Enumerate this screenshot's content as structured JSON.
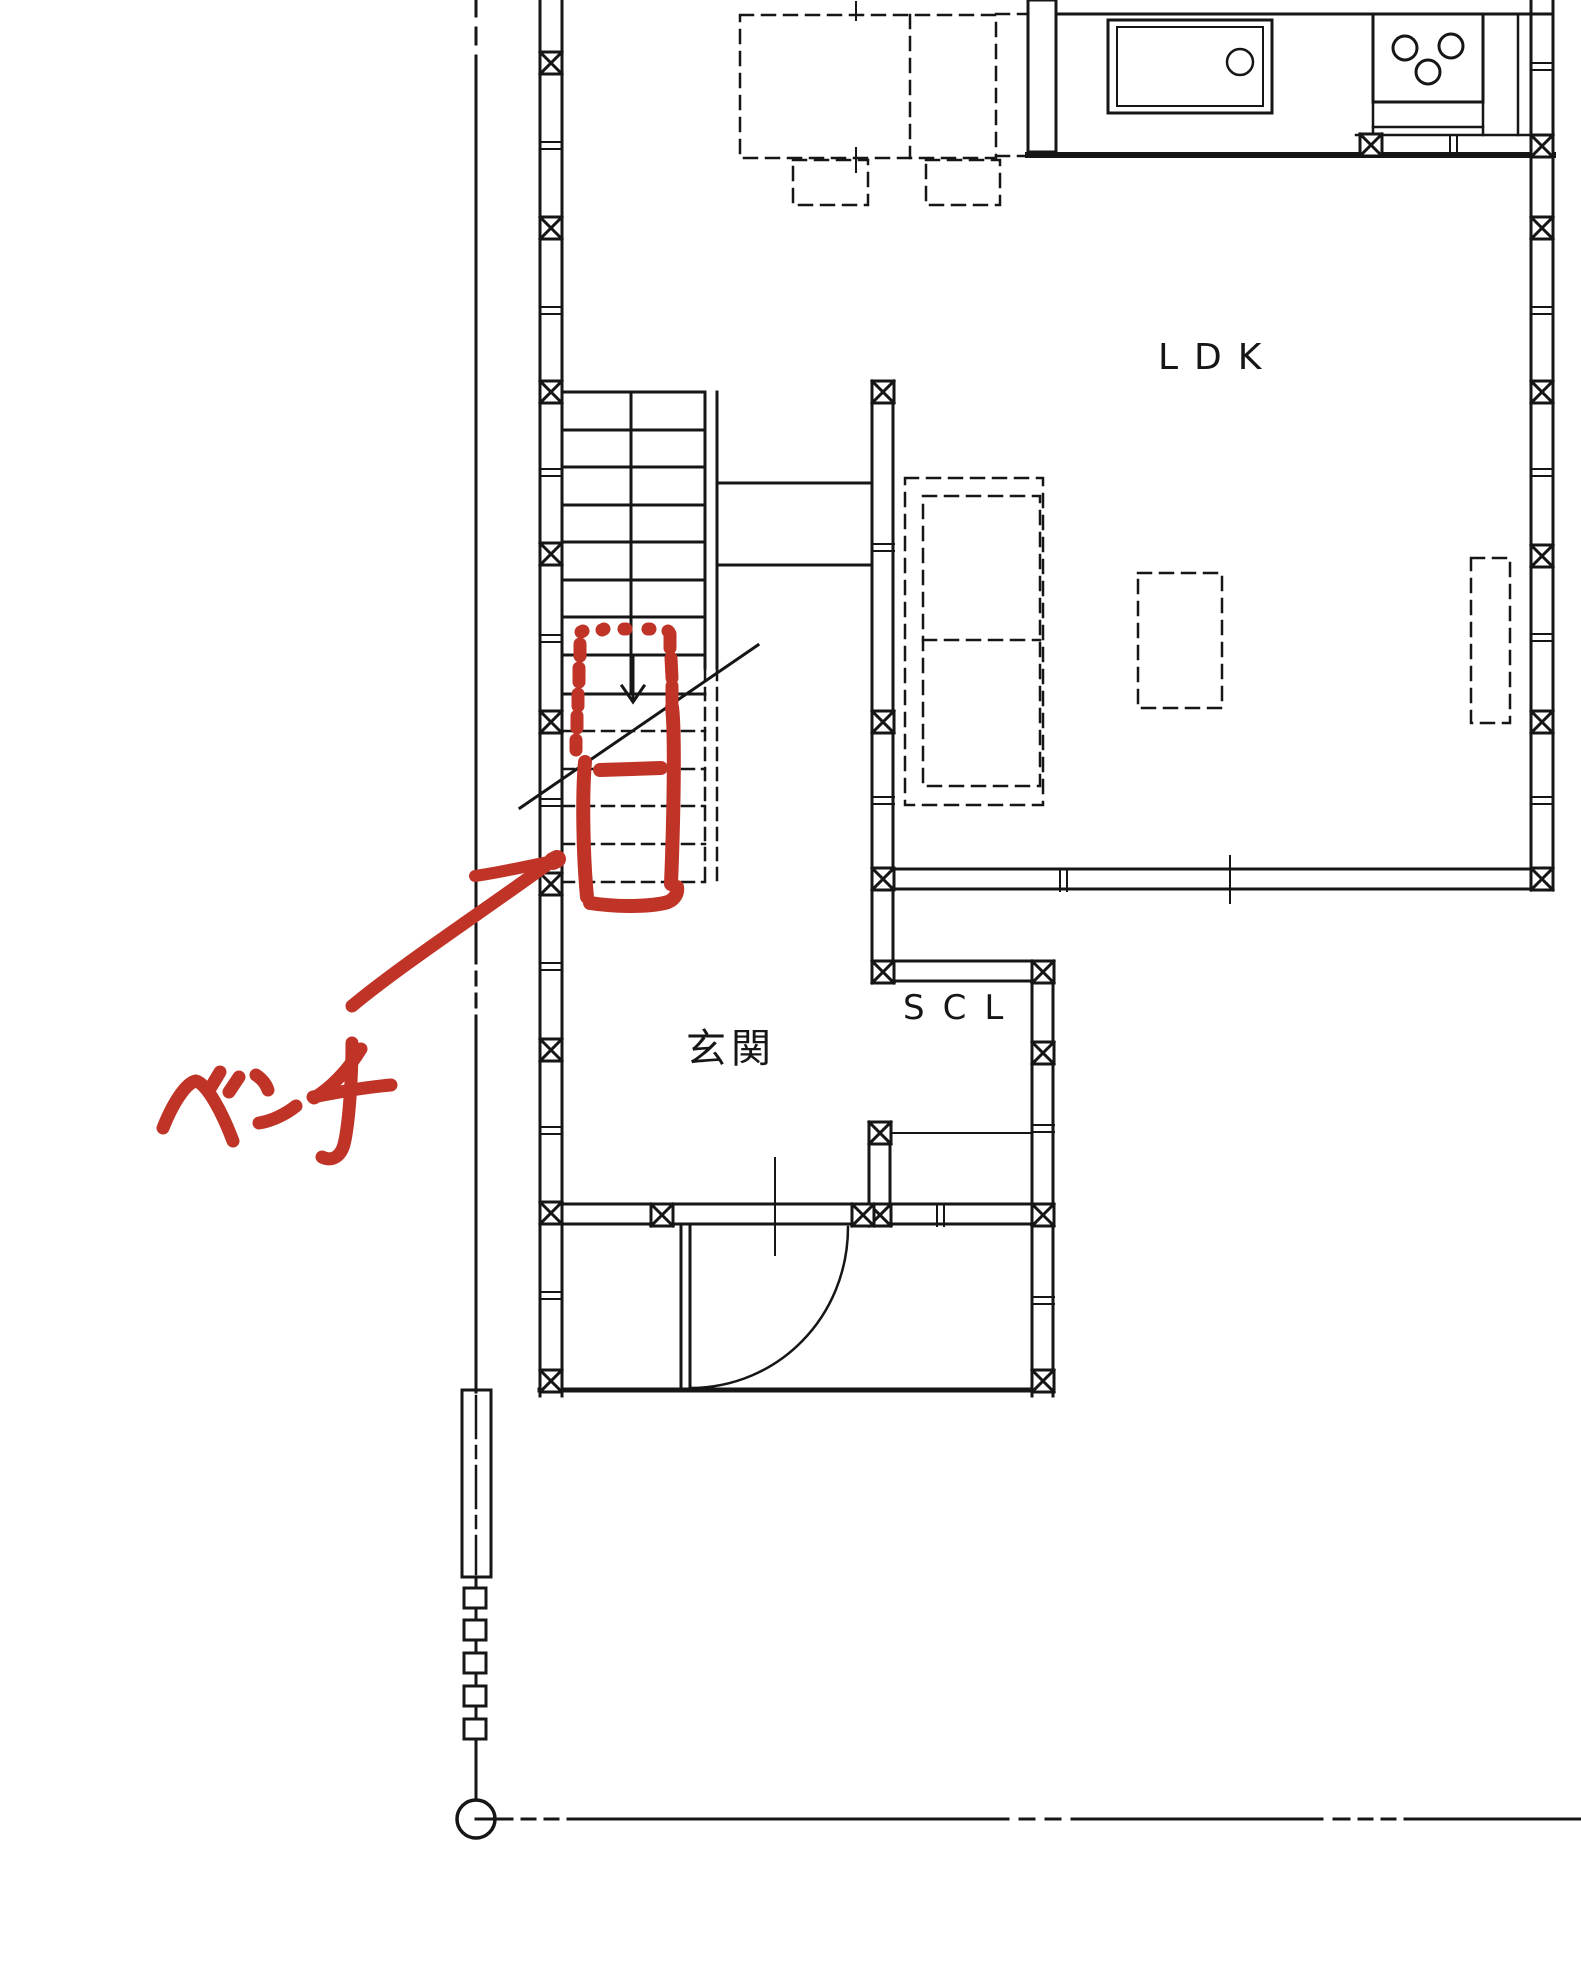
{
  "colors": {
    "line": "#161616",
    "background": "#ffffff",
    "annotation_red": "#c03427"
  },
  "plan": {
    "rooms": [
      {
        "label": "LDK"
      },
      {
        "label": "SCL"
      },
      {
        "label": "玄関"
      }
    ]
  },
  "annotation": {
    "label": "ベンチ"
  }
}
